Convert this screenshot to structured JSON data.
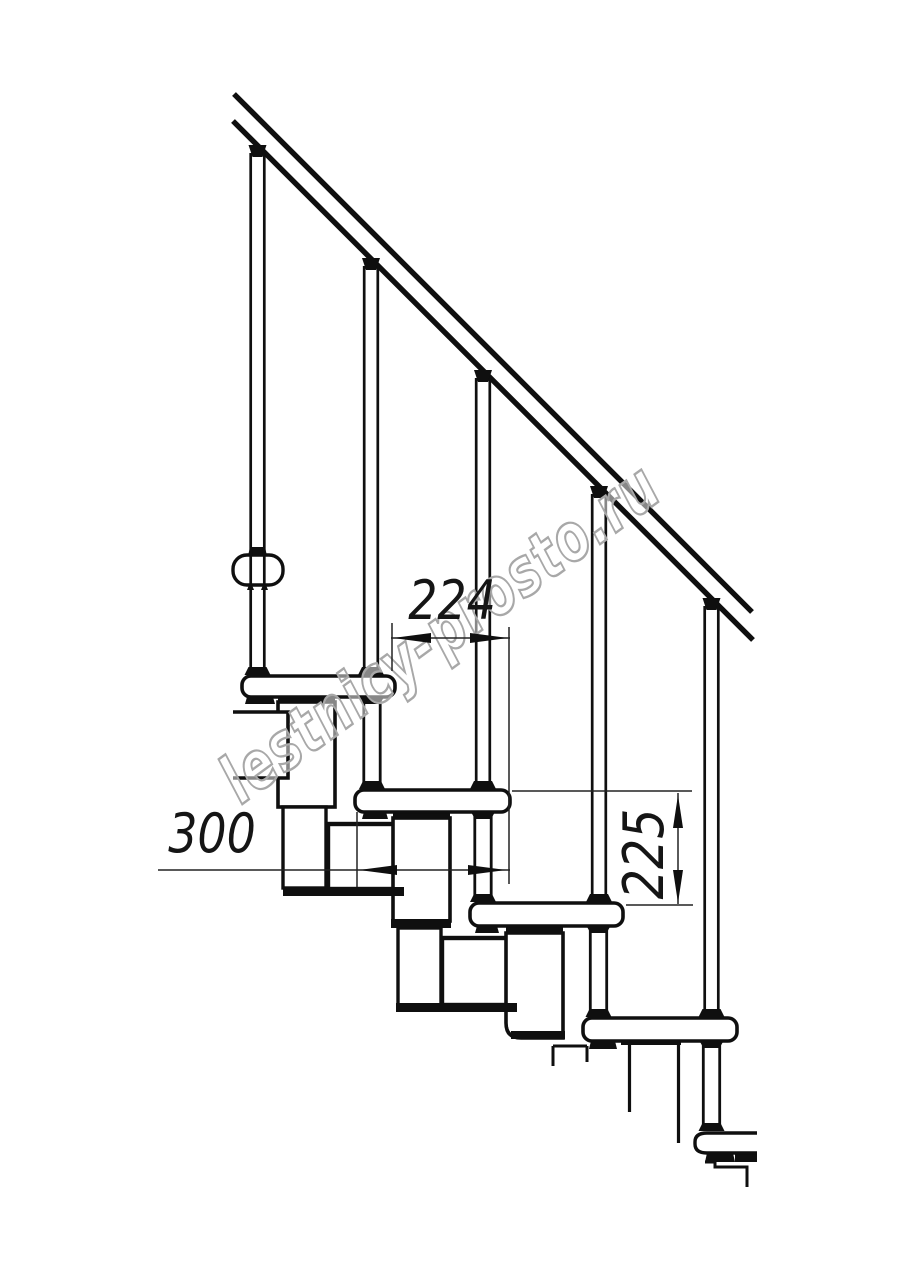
{
  "watermark": {
    "text": "lestnicy-prosto.ru",
    "center_x": 453,
    "center_y": 651,
    "angle_deg": -36,
    "squeeze": 0.75,
    "font_size": 66,
    "letter_spacing": 2,
    "stroke_color": "#a8a8a8",
    "fill_color": "rgba(255,255,255,0.5)"
  },
  "dimensions": [
    {
      "id": "dim-224",
      "label": "224",
      "value_mm": 224,
      "orientation": "horizontal",
      "line": [
        391,
        638,
        510,
        638
      ],
      "arrows": [
        {
          "x": 393,
          "y": 638,
          "dir": "left"
        },
        {
          "x": 508,
          "y": 638,
          "dir": "right"
        }
      ],
      "extensions": [
        [
          392,
          623,
          392,
          671
        ],
        [
          509,
          627,
          509,
          884
        ]
      ],
      "text": {
        "x": 452,
        "y": 619,
        "rotate": 0,
        "size": 54
      }
    },
    {
      "id": "dim-300",
      "label": "300",
      "value_mm": 300,
      "orientation": "horizontal",
      "line": [
        158,
        870,
        510,
        870
      ],
      "arrows": [
        {
          "x": 359,
          "y": 870,
          "dir": "left"
        },
        {
          "x": 506,
          "y": 870,
          "dir": "right"
        }
      ],
      "extensions": [
        [
          357,
          812,
          357,
          887
        ]
      ],
      "text": {
        "x": 212,
        "y": 852,
        "rotate": 0,
        "size": 54
      }
    },
    {
      "id": "dim-225",
      "label": "225",
      "value_mm": 225,
      "orientation": "vertical",
      "line": [
        678,
        793,
        678,
        904
      ],
      "arrows": [
        {
          "x": 678,
          "y": 795,
          "dir": "up"
        },
        {
          "x": 678,
          "y": 903,
          "dir": "down"
        }
      ],
      "extensions": [
        [
          512,
          791,
          692,
          791
        ],
        [
          626,
          905,
          693,
          905
        ]
      ],
      "text": {
        "x": 663,
        "y": 854,
        "rotate": -90,
        "size": 56
      }
    }
  ],
  "drawing": {
    "canvas": {
      "w": 914,
      "h": 1280,
      "bg": "#ffffff"
    },
    "ink": "#0f0f0f",
    "dim_ink": "#222222",
    "rail": {
      "upper": [
        234,
        94,
        752,
        612
      ],
      "lower": [
        233,
        121,
        753,
        640
      ],
      "lw": 5.4
    },
    "balusters": [
      {
        "cx": 257.5,
        "top": 145,
        "foot": 676
      },
      {
        "cx": 371,
        "top": 258,
        "foot": 676
      },
      {
        "cx": 483,
        "top": 370,
        "foot": 790
      },
      {
        "cx": 599,
        "top": 486,
        "foot": 903
      },
      {
        "cx": 711.5,
        "top": 598,
        "foot": 1018
      }
    ],
    "bolts": [
      {
        "cx": 372,
        "y0": 697,
        "y1": 790
      },
      {
        "cx": 483,
        "y0": 812,
        "y1": 903
      },
      {
        "cx": 598.5,
        "y0": 926,
        "y1": 1018
      },
      {
        "cx": 711.5,
        "y0": 1041,
        "y1": 1132
      }
    ],
    "steps": [
      {
        "kind": "rect",
        "x": 233,
        "y": 555,
        "w": 50,
        "h": 30,
        "rx": 14,
        "lw": 3.4
      },
      {
        "kind": "rect",
        "x": 242,
        "y": 676,
        "w": 153,
        "h": 21,
        "rx": 9,
        "lw": 3.6
      },
      {
        "kind": "rect",
        "x": 355,
        "y": 790,
        "w": 155,
        "h": 22,
        "rx": 9,
        "lw": 3.6
      },
      {
        "kind": "rect",
        "x": 470,
        "y": 903,
        "w": 153,
        "h": 23,
        "rx": 9,
        "lw": 3.6
      },
      {
        "kind": "rect",
        "x": 583,
        "y": 1018,
        "w": 154,
        "h": 23,
        "rx": 9,
        "lw": 3.6
      },
      {
        "kind": "path",
        "d": "M757,1133 L707,1133 Q695,1133 695,1142 L695,1144 Q695,1153 707,1153 L757,1153",
        "lw": 3.4
      }
    ],
    "whites": [
      {
        "kind": "rect",
        "x": 278,
        "y": 702,
        "w": 57,
        "h": 105,
        "lw": 3.6
      },
      {
        "kind": "path",
        "d": "M233,712 L288,712 L288,778 L233,778",
        "lw": 3.6
      },
      {
        "kind": "rect",
        "x": 283,
        "y": 807,
        "w": 43,
        "h": 81,
        "lw": 3.4
      },
      {
        "kind": "rect",
        "x": 328,
        "y": 824,
        "w": 76,
        "h": 65,
        "lw": 4.4
      },
      {
        "kind": "rect",
        "x": 393,
        "y": 818,
        "w": 57,
        "h": 103,
        "lw": 3.6
      },
      {
        "kind": "rect",
        "x": 398,
        "y": 928,
        "w": 43,
        "h": 77,
        "lw": 3.4
      },
      {
        "kind": "rect",
        "x": 442,
        "y": 938,
        "w": 76,
        "h": 67,
        "lw": 4.4
      },
      {
        "kind": "path",
        "d": "M506,933 L563,933 L563,1038 L521,1038 Q506,1038 506,1023 Z",
        "lw": 3.6
      }
    ],
    "blacks": [
      {
        "x": 278,
        "y": 697,
        "w": 57,
        "h": 6
      },
      {
        "x": 393,
        "y": 812,
        "w": 57,
        "h": 6
      },
      {
        "x": 506,
        "y": 927,
        "w": 57,
        "h": 6
      },
      {
        "x": 621,
        "y": 1039,
        "w": 60,
        "h": 6
      },
      {
        "x": 391,
        "y": 919,
        "w": 60,
        "h": 9
      },
      {
        "x": 511,
        "y": 1031,
        "w": 54,
        "h": 8
      },
      {
        "x": 283,
        "y": 887,
        "w": 121,
        "h": 9
      },
      {
        "x": 396,
        "y": 1003,
        "w": 121,
        "h": 9
      },
      {
        "x": 735,
        "y": 1151,
        "w": 22,
        "h": 11
      }
    ],
    "clamps": [
      {
        "x": 248,
        "y": 547,
        "w": 19,
        "h": 9
      },
      {
        "x": 247,
        "y": 585,
        "w": 7,
        "h": 5
      },
      {
        "x": 261,
        "y": 585,
        "w": 7,
        "h": 5
      },
      {
        "x": 245,
        "y": 697,
        "w": 30,
        "h": 7
      },
      {
        "x": 362,
        "y": 812,
        "w": 26,
        "h": 7
      },
      {
        "x": 475,
        "y": 926,
        "w": 24,
        "h": 7
      },
      {
        "x": 589,
        "y": 1041,
        "w": 28,
        "h": 8
      },
      {
        "x": 705,
        "y": 1153,
        "w": 30,
        "h": 9
      }
    ],
    "lines": [
      [
        553,
        1046,
        553,
        1066,
        3
      ],
      [
        553,
        1046,
        587,
        1046,
        3
      ],
      [
        587,
        1046,
        587,
        1062,
        3
      ],
      [
        629.5,
        1045,
        629.5,
        1112,
        3.2
      ],
      [
        678.5,
        1045,
        678.5,
        1143,
        3.2
      ]
    ],
    "break_paths": [
      {
        "d": "M705,1162 L715,1162 L715,1167 L747,1167 L747,1187",
        "lw": 3
      }
    ]
  }
}
